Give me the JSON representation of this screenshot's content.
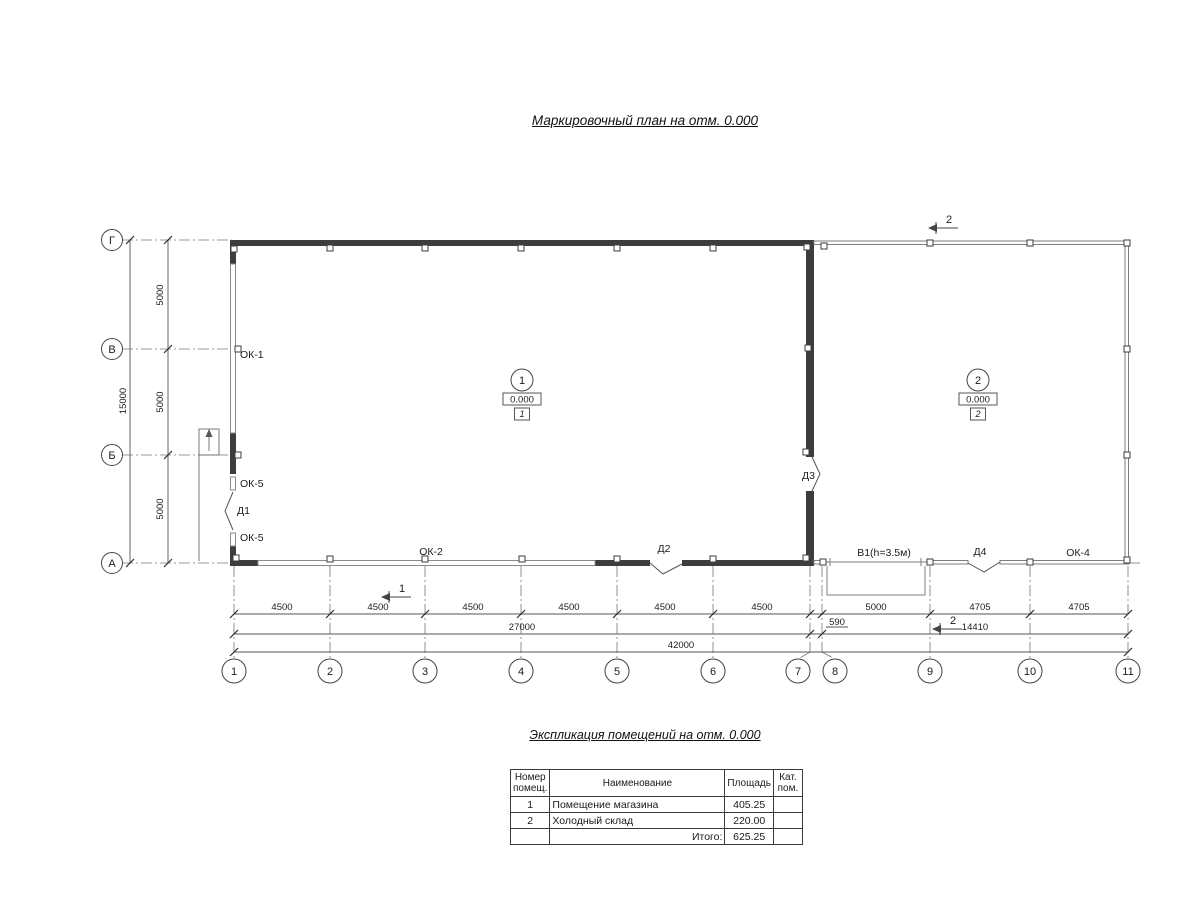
{
  "title": "Маркировочный план  на отм. 0.000",
  "plan": {
    "axes_bottom": [
      "1",
      "2",
      "3",
      "4",
      "5",
      "6",
      "7",
      "8",
      "9",
      "10",
      "11"
    ],
    "axes_left": [
      "Г",
      "В",
      "Б",
      "А"
    ],
    "dims": {
      "row1": [
        "4500",
        "4500",
        "4500",
        "4500",
        "4500",
        "4500",
        "590",
        "5000",
        "4705",
        "4705"
      ],
      "row2": [
        "27000",
        "14410"
      ],
      "total": "42000",
      "left_segments": [
        "5000",
        "5000",
        "5000"
      ],
      "left_total": "15000"
    },
    "labels": {
      "ok1": "ОК-1",
      "ok5_top": "ОК-5",
      "d1": "Д1",
      "ok5_bottom": "ОК-5",
      "ok2": "ОК-2",
      "d2": "Д2",
      "d3": "Д3",
      "v1": "В1(h=3.5м)",
      "d4": "Д4",
      "ok4": "ОК-4"
    },
    "rooms": [
      {
        "number": "1",
        "elevation": "0.000",
        "tag": "1"
      },
      {
        "number": "2",
        "elevation": "0.000",
        "tag": "2"
      }
    ],
    "sections": {
      "top": "2",
      "bottom_left": "1",
      "bottom_right": "2"
    }
  },
  "table": {
    "title": "Экспликация помещений на отм. 0.000",
    "headers": [
      "Номер помещ.",
      "Наименование",
      "Площадь",
      "Кат. пом."
    ],
    "rows": [
      {
        "num": "1",
        "name": "Помещение магазина",
        "area": "405.25",
        "cat": ""
      },
      {
        "num": "2",
        "name": "Холодный склад",
        "area": "220.00",
        "cat": ""
      }
    ],
    "total_label": "Итого:",
    "total_value": "625.25"
  },
  "colors": {
    "wall": "#3d3d3d",
    "thin_line": "#8a8a8a",
    "dim_line": "#555555",
    "text": "#1c1c1c"
  }
}
